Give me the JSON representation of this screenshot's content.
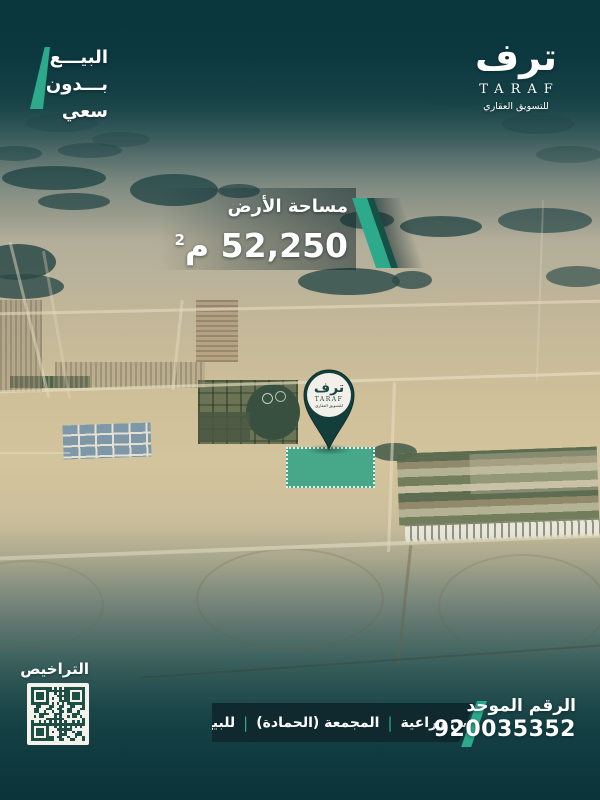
{
  "badge": {
    "line1": "البيـــع",
    "line2": "بـــدون",
    "line3": "سعي"
  },
  "brand": {
    "calligraphy": "ترف",
    "wordmark": "TARAF",
    "tagline": "للتسويق العقاري"
  },
  "area_banner": {
    "label": "مساحة الأرض",
    "value": "52,250",
    "unit": "م",
    "unit_exponent": "2"
  },
  "map_pin": {
    "calligraphy": "ترف",
    "wordmark": "TARAF",
    "tagline": "للتسويق العقاري"
  },
  "licenses": {
    "label": "التراخيص"
  },
  "bottom_bar": {
    "unified_label": "الرقم الموحد",
    "unified_number": "920035352",
    "separator": "|",
    "tags": [
      "أرضين زراعية",
      "المجمعة (الحمادة)",
      "للبيع"
    ]
  },
  "colors": {
    "accent_teal": "#2da98c",
    "dark_teal_overlay": "#0d3941",
    "band_dark": "#0f2830",
    "pin_dark": "#143e3b",
    "plot_fill": "#28a286",
    "qr_dark": "#1e4f44"
  }
}
